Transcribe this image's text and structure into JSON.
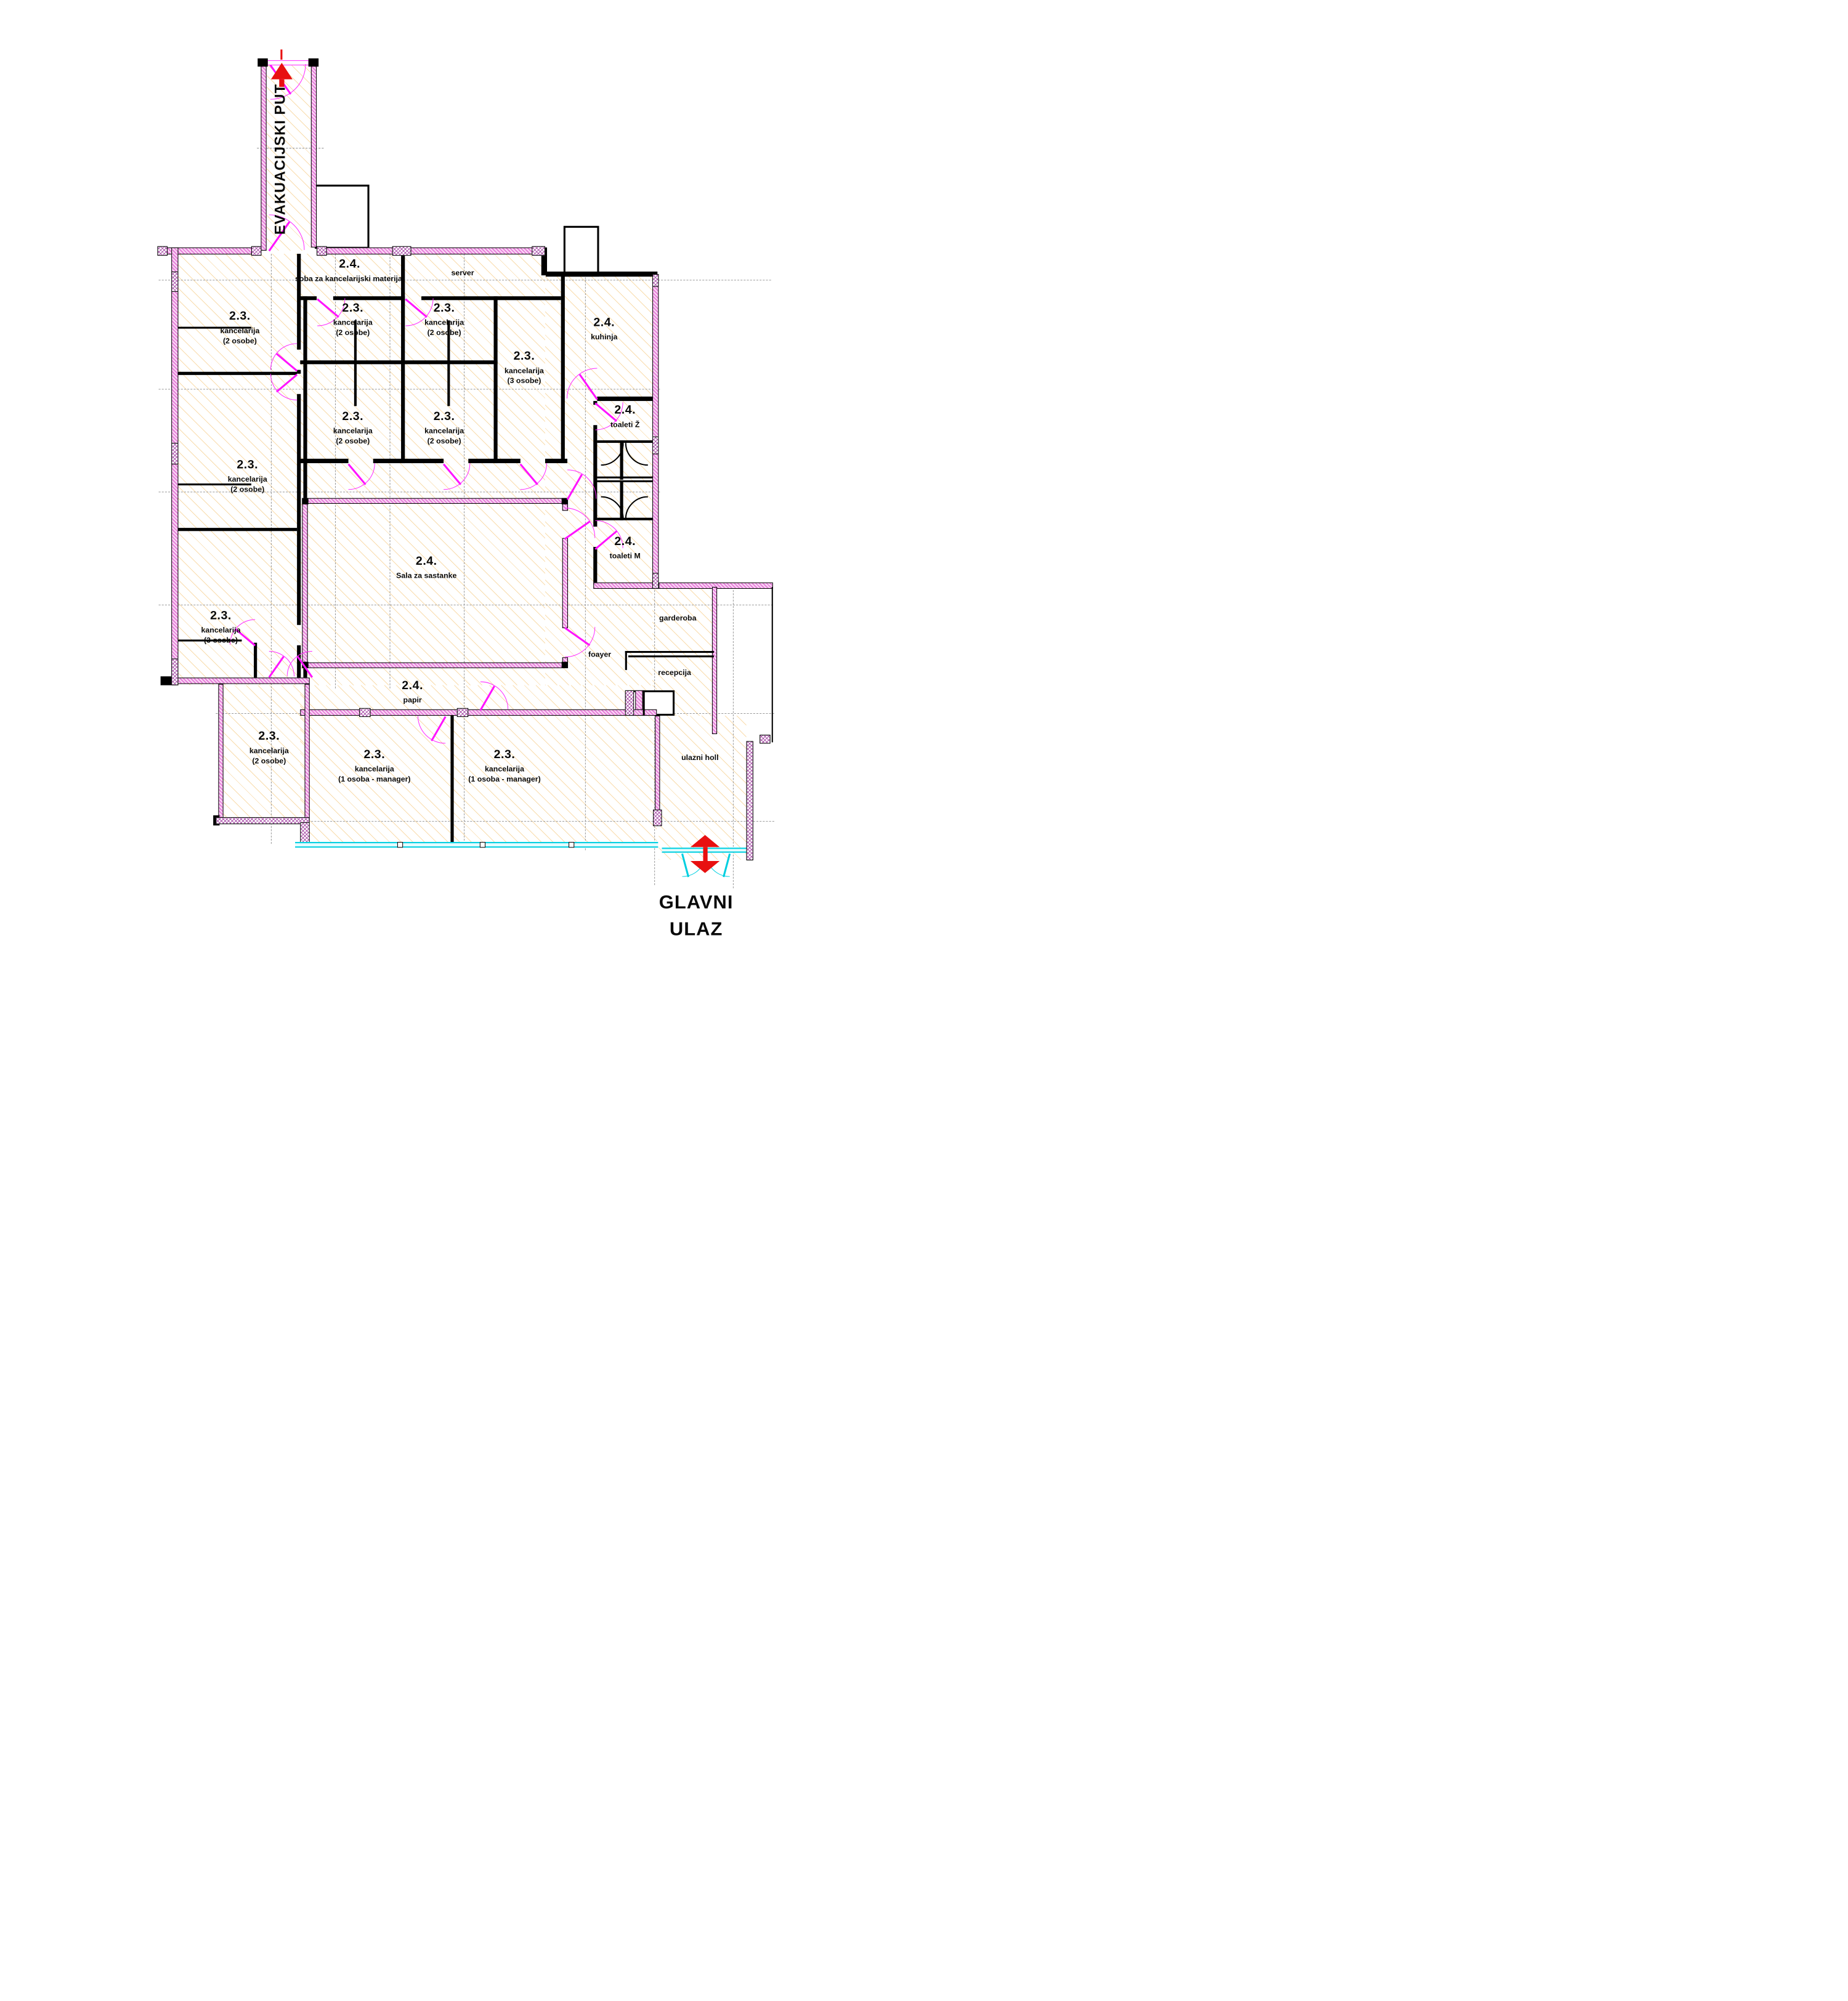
{
  "labels": {
    "evacuation_route": "EVAKUACIJSKI PUT",
    "main_entrance_line1": "GLAVNI",
    "main_entrance_line2": "ULAZ"
  },
  "rooms": [
    {
      "code": "2.3.",
      "name": "kancelarija",
      "sub": "(2 osobe)"
    },
    {
      "code": "2.3.",
      "name": "kancelarija",
      "sub": "(2 osobe)"
    },
    {
      "code": "2.3.",
      "name": "kancelarija",
      "sub": "(3 osobe)"
    },
    {
      "code": "2.4.",
      "name": "soba za kancelarijski materijal",
      "sub": ""
    },
    {
      "code": "",
      "name": "server",
      "sub": ""
    },
    {
      "code": "2.3.",
      "name": "kancelarija",
      "sub": "(2 osobe)"
    },
    {
      "code": "2.3.",
      "name": "kancelarija",
      "sub": "(2 osobe)"
    },
    {
      "code": "2.3.",
      "name": "kancelarija",
      "sub": "(2 osobe)"
    },
    {
      "code": "2.3.",
      "name": "kancelarija",
      "sub": "(2 osobe)"
    },
    {
      "code": "2.3.",
      "name": "kancelarija",
      "sub": "(3 osobe)"
    },
    {
      "code": "2.4.",
      "name": "kuhinja",
      "sub": ""
    },
    {
      "code": "2.4.",
      "name": "toaleti Ž",
      "sub": ""
    },
    {
      "code": "2.4.",
      "name": "toaleti M",
      "sub": ""
    },
    {
      "code": "2.4.",
      "name": "Sala za sastanke",
      "sub": ""
    },
    {
      "code": "",
      "name": "garderoba",
      "sub": ""
    },
    {
      "code": "",
      "name": "foayer",
      "sub": ""
    },
    {
      "code": "",
      "name": "recepcija",
      "sub": ""
    },
    {
      "code": "2.4.",
      "name": "papir",
      "sub": ""
    },
    {
      "code": "2.3.",
      "name": "kancelarija",
      "sub": "(2 osobe)"
    },
    {
      "code": "2.3.",
      "name": "kancelarija",
      "sub": "(1 osoba - manager)"
    },
    {
      "code": "2.3.",
      "name": "kancelarija",
      "sub": "(1 osoba - manager)"
    },
    {
      "code": "",
      "name": "ulazni holl",
      "sub": ""
    }
  ],
  "colors": {
    "wall": "#000000",
    "window_band": "#e879dd",
    "pier_hatch": "#a03ca0",
    "door": "#ff14ff",
    "glass": "#00cfe0",
    "floor_hatch": "#f0a830",
    "arrow": "#e81010",
    "grid": "#999999"
  }
}
